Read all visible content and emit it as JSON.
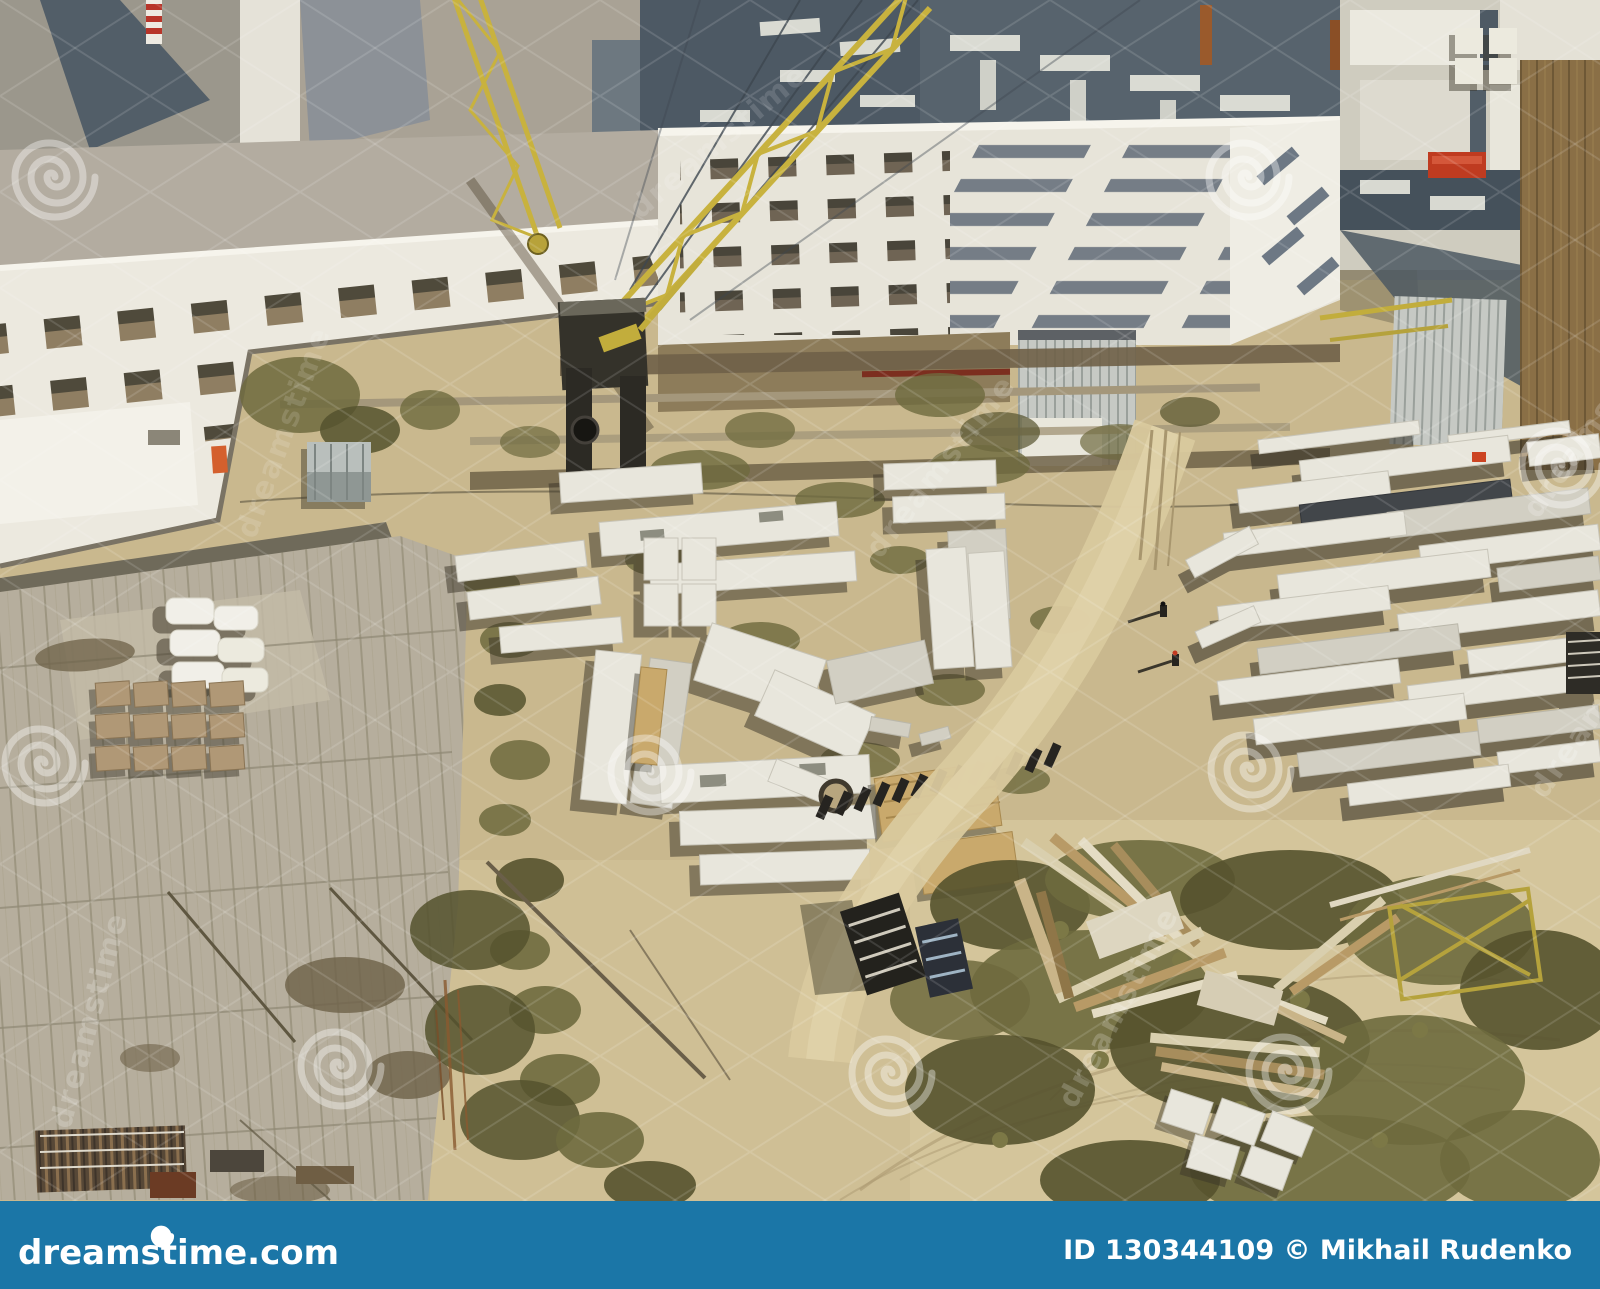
{
  "footer": {
    "brand": "dreamstime.com",
    "credit": "ID 130344109 © Mikhail Rudenko",
    "bar_color": "#1b76a7",
    "text_color": "#ffffff"
  },
  "watermark": {
    "text": "dreamstime"
  },
  "palette": {
    "sand": "#c9b88e",
    "sand_light": "#d4c59b",
    "concrete_lot": "#b6ae9d",
    "slab_white": "#e8e6dc",
    "crane_yellow": "#c8b23e",
    "vegetation": "#6e6a3e",
    "deep_shadow": "#4b4535",
    "roof_dark": "#57636d",
    "dumpster_red": "#bf3b20"
  }
}
